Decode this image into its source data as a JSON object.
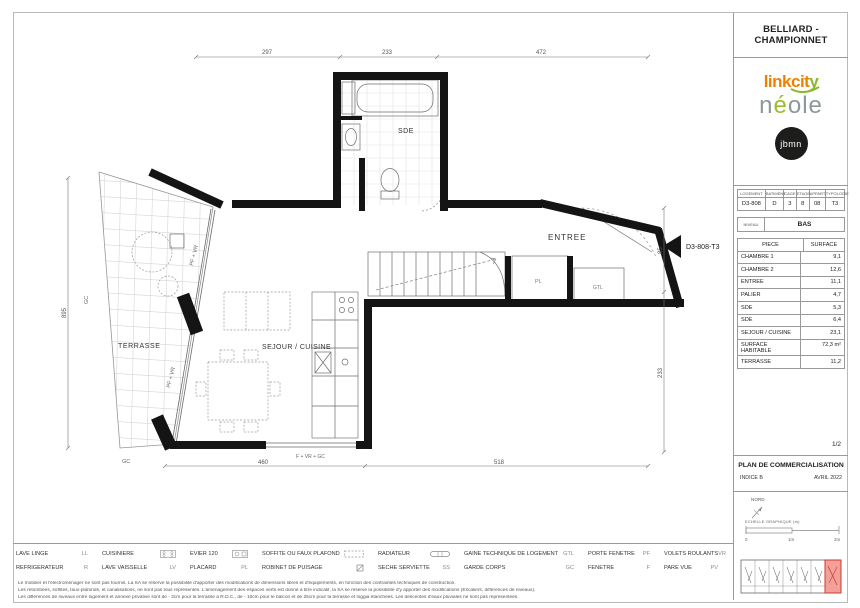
{
  "header": {
    "project_title": "BELLIARD - CHAMPIONNET"
  },
  "logos": {
    "linkcity_prefix": "linkcit",
    "linkcity_suffix": "y",
    "neole_n": "n",
    "neole_accent": "é",
    "neole_rest": "ole",
    "jbmn": "jbmn"
  },
  "unit_table": {
    "headers": [
      "LOGEMENT",
      "BATIMENT",
      "CAGE",
      "ETAGE",
      "APPART.",
      "TYPOLOGIE"
    ],
    "values": [
      "D3-808",
      "D",
      "3",
      "8",
      "08",
      "T3"
    ]
  },
  "niveau": {
    "label": "NIVEAU",
    "value": "BAS"
  },
  "surface_table": {
    "col_piece": "PIECE",
    "col_surface": "SURFACE",
    "rows": [
      {
        "piece": "CHAMBRE 1",
        "surface": "9,1"
      },
      {
        "piece": "CHAMBRE 2",
        "surface": "12,6"
      },
      {
        "piece": "ENTREE",
        "surface": "11,1"
      },
      {
        "piece": "PALIER",
        "surface": "4,7"
      },
      {
        "piece": "SDE",
        "surface": "5,3"
      },
      {
        "piece": "SDE",
        "surface": "6,4"
      },
      {
        "piece": "SEJOUR / CUISINE",
        "surface": "23,1"
      },
      {
        "piece": "SURFACE HABITABLE",
        "surface": "72,3 m²"
      },
      {
        "piece": "TERRASSE",
        "surface": "11,2"
      }
    ]
  },
  "title_block": {
    "page_number": "1/2",
    "title": "PLAN DE COMMERCIALISATION",
    "indice": "INDICE B",
    "date": "AVRIL 2022"
  },
  "compass": {
    "label": "NORD"
  },
  "scale_bar": {
    "label": "ECHELLE GRAPHIQUE (m)",
    "tick0": "0",
    "tick1": "1m",
    "tick2": "2m"
  },
  "plan": {
    "labels": {
      "sde": "SDE",
      "entree": "ENTREE",
      "sejour_cuisine": "SEJOUR / CUISINE",
      "terrasse": "TERRASSE",
      "placard": "PL",
      "gtl": "GTL",
      "unit": "D3-808-T3",
      "bay_upper": "PF + VR",
      "bay_lower": "PF + VR",
      "gc_left": "GC",
      "gc_bottom": "GC",
      "window_bottom": "F + VR + GC"
    },
    "dims": {
      "top_1": "297",
      "top_2": "233",
      "top_3": "472",
      "left_1": "895",
      "right_1": "85",
      "right_2": "233",
      "bottom_1": "460",
      "bottom_2": "518"
    }
  },
  "legend": {
    "items": [
      {
        "label": "LAVE LINGE",
        "sym": "LL"
      },
      {
        "label": "CUISINIERE",
        "sym": ""
      },
      {
        "label": "EVIER 120",
        "sym": ""
      },
      {
        "label": "SOFFITE OU FAUX PLAFOND",
        "sym": ""
      },
      {
        "label": "RADIATEUR",
        "sym": ""
      },
      {
        "label": "GAINE TECHNIQUE DE LOGEMENT",
        "sym": "GTL"
      },
      {
        "label": "PORTE FENETRE",
        "sym": "PF"
      },
      {
        "label": "VOLETS ROULANTS",
        "sym": "VR"
      },
      {
        "label": "REFRIGERATEUR",
        "sym": "R"
      },
      {
        "label": "LAVE VAISSELLE",
        "sym": "LV"
      },
      {
        "label": "PLACARD",
        "sym": "PL"
      },
      {
        "label": "ROBINET DE PUISAGE",
        "sym": ""
      },
      {
        "label": "SECHE SERVIETTE",
        "sym": "SS"
      },
      {
        "label": "GARDE CORPS",
        "sym": "GC"
      },
      {
        "label": "FENETRE",
        "sym": "F"
      },
      {
        "label": "PARE VUE",
        "sym": "PV"
      }
    ]
  },
  "disclaimer": {
    "line1": "Le mobilier et l'électroménager ne sont pas fournis. La SA se réserve la possibilité d'apporter des modifications de dimensions libres et d'équipements, en fonction des contraintes techniques de construction.",
    "line2": "Les retombées, soffites, faux-plafonds, et canalisations, ne sont pas tous représentés. L'aménagement des espaces verts est donné à titre indicatif, la SA se réserve la possibilité d'y apporter des modifications (Escaliers, différences de niveaux).",
    "line3": "Les différences de niveaux entre logement et annexe privative sont de - 2cm pour la terrasse à R.D.C., de - 10cm pour le balcon et de 25cm pour la terrasse et loggia étanchées. Les descentes d'eaux pluviales ne sont pas représentées."
  },
  "colors": {
    "accent_orange": "#ef8100",
    "accent_green": "#8bb829",
    "highlight_red": "#d3352b"
  }
}
